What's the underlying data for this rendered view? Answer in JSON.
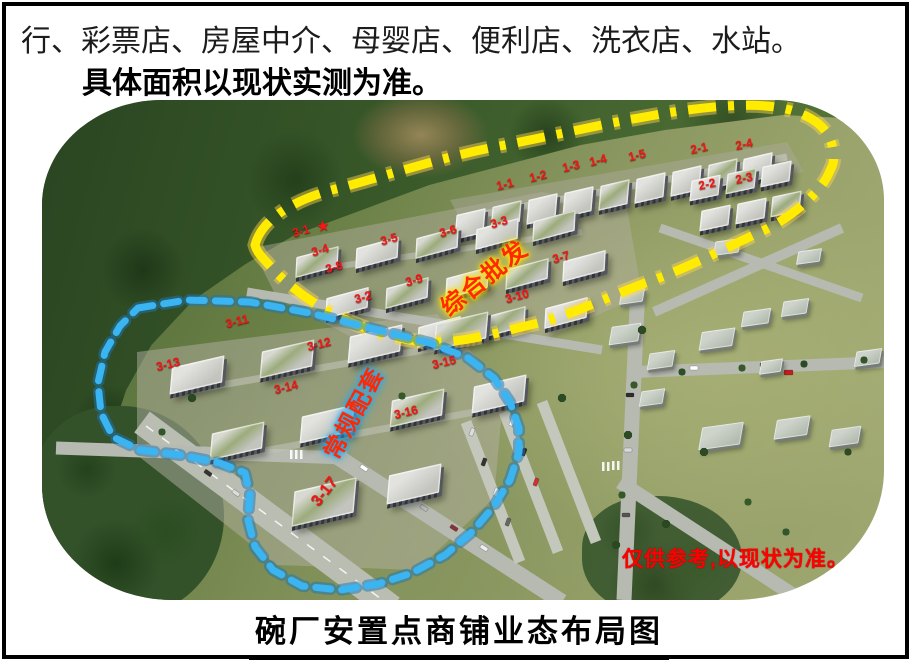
{
  "page": {
    "line1": "行、彩票店、房屋中介、母婴店、便利店、洗衣店、水站。",
    "line2": "具体面积以现状实测为准。",
    "footer_title": "碗厂安置点商铺业态布局图"
  },
  "map": {
    "note": "仅供参考,以现状为准。",
    "zones": [
      {
        "label": "综合批发",
        "x": 483,
        "y": 276,
        "rotate": -39,
        "size": 24,
        "color": "#ff2800",
        "glow": "#ffe400"
      },
      {
        "label": "常规配套",
        "x": 352,
        "y": 412,
        "rotate": -62,
        "size": 23,
        "color": "#ff2800",
        "glow": "#25aaf0"
      }
    ],
    "star": {
      "symbol": "★",
      "x": 323,
      "y": 226,
      "rotate": -10
    },
    "building_labels": [
      {
        "t": "1-1",
        "x": 505,
        "y": 184,
        "r": -14
      },
      {
        "t": "1-2",
        "x": 538,
        "y": 176,
        "r": -14
      },
      {
        "t": "1-3",
        "x": 571,
        "y": 166,
        "r": -14
      },
      {
        "t": "1-4",
        "x": 598,
        "y": 160,
        "r": -14
      },
      {
        "t": "1-5",
        "x": 637,
        "y": 155,
        "r": -14
      },
      {
        "t": "2-1",
        "x": 699,
        "y": 148,
        "r": -12
      },
      {
        "t": "2-4",
        "x": 744,
        "y": 144,
        "r": -12
      },
      {
        "t": "2-2",
        "x": 707,
        "y": 184,
        "r": -12
      },
      {
        "t": "2-3",
        "x": 744,
        "y": 178,
        "r": -12
      },
      {
        "t": "3-1",
        "x": 301,
        "y": 231,
        "r": -16
      },
      {
        "t": "3-4",
        "x": 320,
        "y": 250,
        "r": -16
      },
      {
        "t": "3-5",
        "x": 389,
        "y": 239,
        "r": -16
      },
      {
        "t": "3-6",
        "x": 448,
        "y": 231,
        "r": -16
      },
      {
        "t": "3-3",
        "x": 499,
        "y": 222,
        "r": -16
      },
      {
        "t": "3-8",
        "x": 334,
        "y": 267,
        "r": -16
      },
      {
        "t": "3-9",
        "x": 414,
        "y": 280,
        "r": -16
      },
      {
        "t": "3-2",
        "x": 363,
        "y": 297,
        "r": -16
      },
      {
        "t": "3-7",
        "x": 561,
        "y": 257,
        "r": -16
      },
      {
        "t": "3-10",
        "x": 517,
        "y": 296,
        "r": -16
      },
      {
        "t": "3-11",
        "x": 237,
        "y": 321,
        "r": -14
      },
      {
        "t": "3-12",
        "x": 319,
        "y": 344,
        "r": -14
      },
      {
        "t": "3-13",
        "x": 168,
        "y": 364,
        "r": -14
      },
      {
        "t": "3-14",
        "x": 286,
        "y": 387,
        "r": -14
      },
      {
        "t": "3-15",
        "x": 444,
        "y": 362,
        "r": -14
      },
      {
        "t": "3-16",
        "x": 406,
        "y": 412,
        "r": -14
      },
      {
        "t": "3-17",
        "x": 325,
        "y": 492,
        "r": -52,
        "s": 16
      }
    ],
    "colors": {
      "yellow": "#ffec00",
      "blue": "#3bb4f2",
      "label_red": "#f81414",
      "note_red": "#ff0000"
    }
  }
}
